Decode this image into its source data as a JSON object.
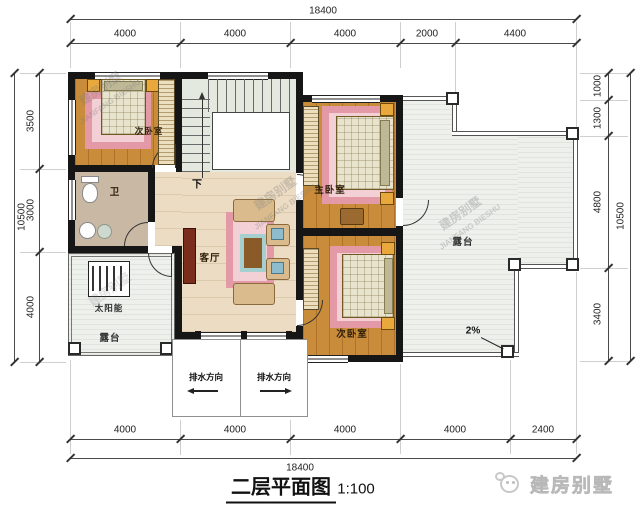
{
  "title": {
    "text": "二层平面图",
    "scale": "1:100"
  },
  "logo": {
    "text": "建房别墅",
    "icon": "mascot-face-icon"
  },
  "watermark": {
    "cn": "建房别墅",
    "en": "JIANFANG BIESHU"
  },
  "rooms": {
    "bedroom_top_left": "次卧室",
    "master_bedroom": "主卧室",
    "bedroom_bottom_right": "次卧室",
    "living_room": "客厅",
    "bathroom": "卫",
    "terrace_right": "露台",
    "terrace_bottom_left": "露台",
    "solar_water_heater": "太阳能"
  },
  "annotations": {
    "stairs_down": "下",
    "roof_slope": "2%",
    "drainage_left": "排水方向",
    "drainage_right": "排水方向"
  },
  "dimensions": {
    "top_total": "18400",
    "top_segments": [
      "4000",
      "4000",
      "4000",
      "2000",
      "4400"
    ],
    "bottom_segments": [
      "4000",
      "4000",
      "4000",
      "4000",
      "2400"
    ],
    "bottom_total": "18400",
    "left_total": "10500",
    "left_segments": [
      "3500",
      "3000",
      "4000"
    ],
    "right_segments": [
      "1000",
      "1300",
      "4800",
      "3400"
    ],
    "right_total": "10500"
  },
  "colors": {
    "wall": "#161616",
    "wood_floor": "#c98c3a",
    "hall_floor": "#ecdcc3",
    "stair_floor": "#e3e9df",
    "bath_floor": "#c8b8a4",
    "terrace_floor": "#eef0ec",
    "rug_pink": "#e49aa6",
    "lamp_orange": "#e8a83c",
    "sofa_tan": "#d9bb8e"
  }
}
